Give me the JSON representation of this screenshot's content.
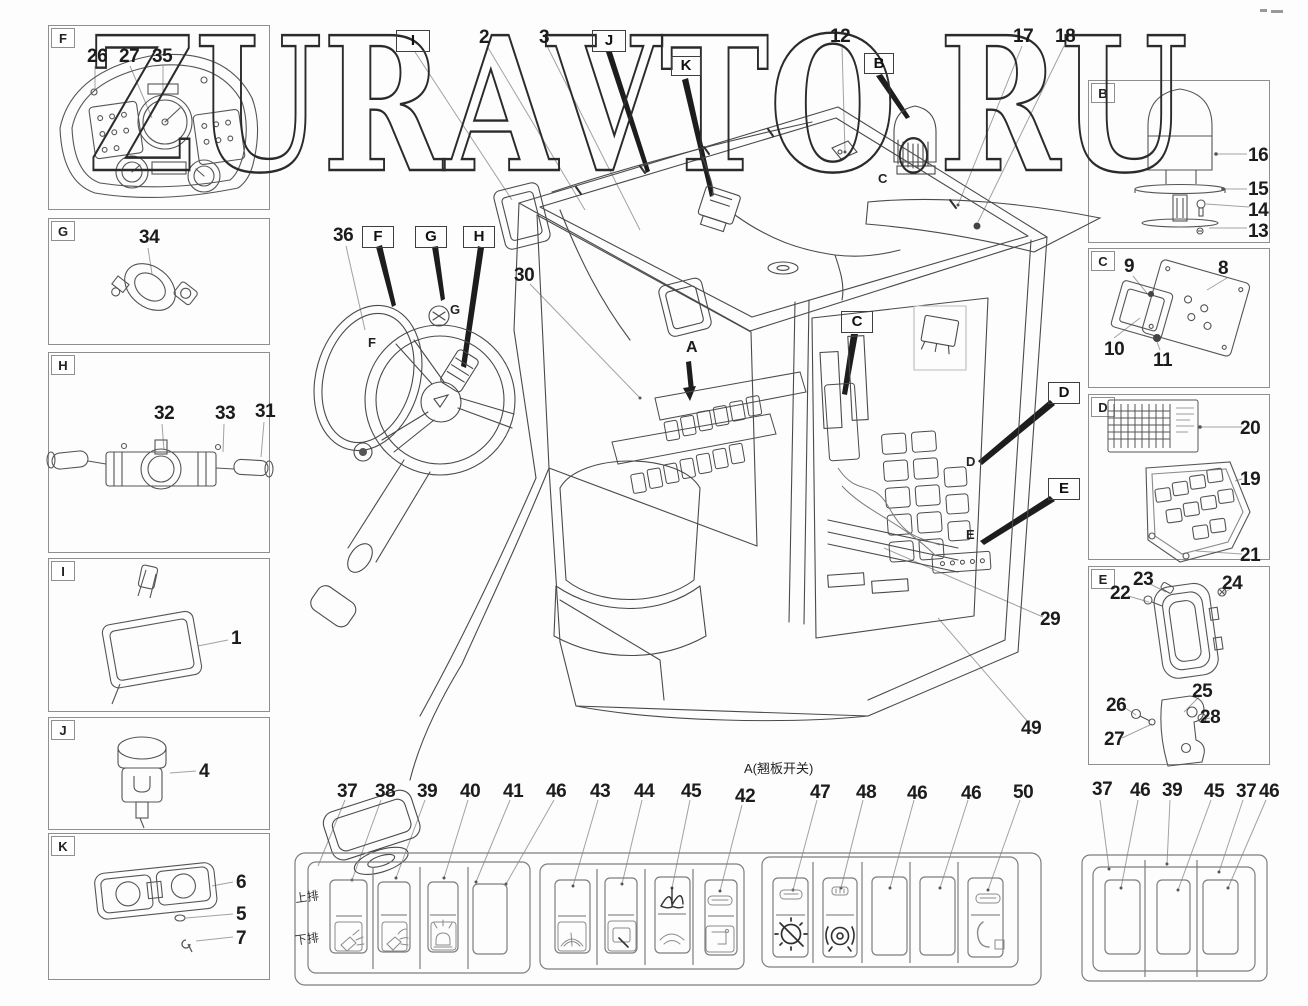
{
  "watermark": "ZURAVTO.RU",
  "panels_left": [
    {
      "letter": "F",
      "c": [
        "26",
        "27",
        "35"
      ]
    },
    {
      "letter": "G",
      "c": [
        "34"
      ]
    },
    {
      "letter": "H",
      "c": [
        "32",
        "33",
        "31"
      ]
    },
    {
      "letter": "I",
      "c": [
        "1"
      ]
    },
    {
      "letter": "J",
      "c": [
        "4"
      ]
    },
    {
      "letter": "K",
      "c": [
        "6",
        "5",
        "7"
      ]
    }
  ],
  "panels_right": [
    {
      "letter": "B",
      "c": [
        "16",
        "15",
        "14",
        "13"
      ]
    },
    {
      "letter": "C",
      "c": [
        "9",
        "8",
        "10",
        "11"
      ]
    },
    {
      "letter": "D",
      "c": [
        "20",
        "19",
        "21"
      ]
    },
    {
      "letter": "E",
      "c": [
        "22",
        "23",
        "24",
        "25",
        "26",
        "27",
        "28"
      ]
    }
  ],
  "cab": {
    "top": [
      {
        "t": "I"
      },
      {
        "t": "2"
      },
      {
        "t": "3"
      },
      {
        "t": "J"
      },
      {
        "t": "K"
      },
      {
        "t": "12"
      },
      {
        "t": "B"
      },
      {
        "t": "17"
      },
      {
        "t": "18"
      }
    ],
    "steering": [
      {
        "t": "36"
      },
      {
        "t": "F"
      },
      {
        "t": "G"
      },
      {
        "t": "H"
      },
      {
        "t": "30"
      }
    ],
    "interior": [
      {
        "t": "A"
      },
      {
        "t": "C"
      },
      {
        "t": "D"
      },
      {
        "t": "E"
      },
      {
        "t": "29"
      },
      {
        "t": "49"
      }
    ],
    "letters": [
      {
        "t": "C"
      },
      {
        "t": "G"
      },
      {
        "t": "F"
      },
      {
        "t": "D"
      },
      {
        "t": "E"
      }
    ]
  },
  "bottom": {
    "title": "A(翘板开关)",
    "rows": [
      "上排",
      "下排"
    ],
    "nums": [
      "37",
      "38",
      "39",
      "40",
      "41",
      "46",
      "43",
      "44",
      "45",
      "42",
      "47",
      "48",
      "46",
      "46",
      "50"
    ],
    "right_nums": [
      "37",
      "46",
      "39",
      "45",
      "37",
      "46"
    ],
    "switch_icons": [
      "worklight-front",
      "worklight-rear",
      "rotating-beacon",
      "blank",
      "wiper",
      "washer",
      "mirror-demist",
      "latch",
      "gear-disable",
      "diff-lock",
      "blank",
      "blank",
      "power-latch",
      "blank",
      "blank",
      "blank"
    ]
  }
}
